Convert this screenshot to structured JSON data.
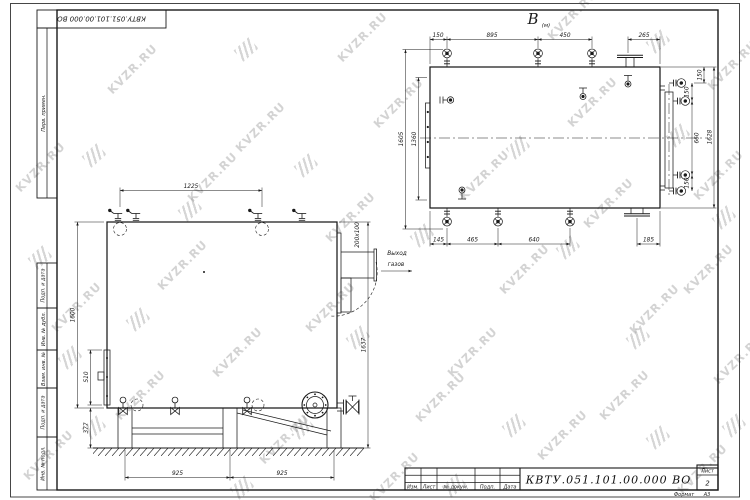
{
  "watermark": {
    "text": "KVZR.RU"
  },
  "stamp": {
    "doc_number_rotated": "КВТУ.051.101.00.000 ВО"
  },
  "sidebar": {
    "labels": [
      "Перв. примен.",
      "Подп. и дата",
      "Инв. № дубл.",
      "Взам. инв. №",
      "Подп. и дата",
      "Инв. № подл."
    ]
  },
  "top_view": {
    "label": "В",
    "label_sub": "(м)",
    "dims_top": [
      "150",
      "895",
      "450",
      "265"
    ],
    "dims_left": [
      "1605",
      "1360"
    ],
    "dims_bottom": [
      "145",
      "465",
      "640",
      "185"
    ],
    "dims_right": [
      "150",
      "150",
      "660",
      "150",
      "1628"
    ]
  },
  "front_view": {
    "dim_top": "1225",
    "dims_left": [
      "1600",
      "510",
      "377"
    ],
    "dim_right": "1637",
    "dims_bottom": [
      "925",
      "925"
    ],
    "duct_size": "200x100",
    "outlet_label": [
      "Выход",
      "газов"
    ]
  },
  "title_block": {
    "doc_number": "КВТУ.051.101.00.000  ВО",
    "columns": [
      "Изм.",
      "Лист",
      "№ докум.",
      "Подп.",
      "Дата"
    ],
    "sheet_label": "Лист",
    "sheet_number": "2",
    "format_label": "Формат",
    "format_value": "А3"
  }
}
